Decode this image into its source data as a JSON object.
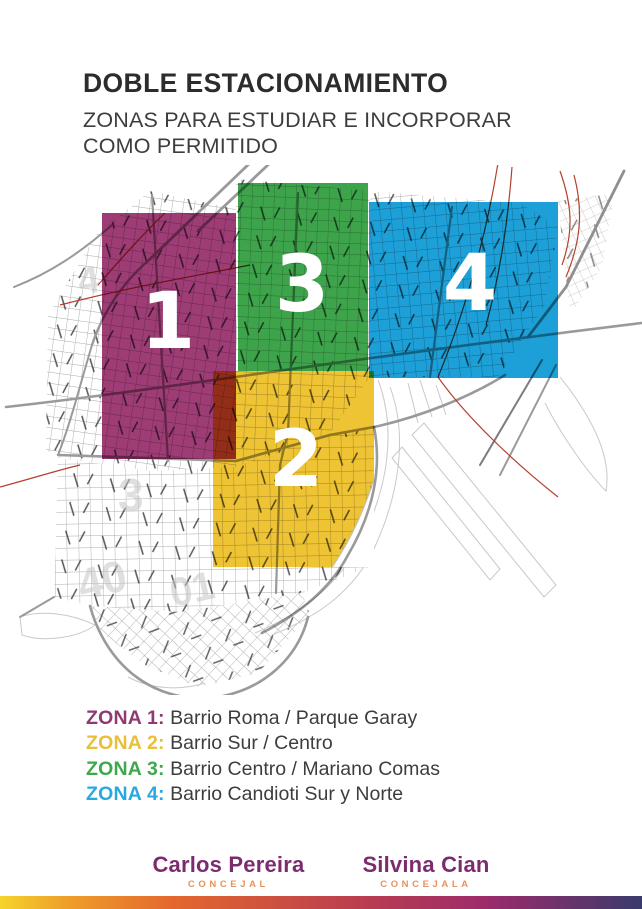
{
  "header": {
    "title": "DOBLE ESTACIONAMIENTO",
    "subtitle_line1": "ZONAS PARA ESTUDIAR E INCORPORAR",
    "subtitle_line2": "COMO PERMITIDO"
  },
  "map": {
    "zones": [
      {
        "number": "1",
        "color": "#9d3c75"
      },
      {
        "number": "2",
        "color": "#eec334"
      },
      {
        "number": "3",
        "color": "#3ea44b"
      },
      {
        "number": "4",
        "color": "#1d9fd8"
      }
    ],
    "watermarks": [
      "4",
      "3",
      "40",
      "01"
    ]
  },
  "legend": {
    "items": [
      {
        "label": "ZONA 1:",
        "value": "Barrio Roma / Parque Garay",
        "color": "#8e3a70"
      },
      {
        "label": "ZONA 2:",
        "value": "Barrio Sur / Centro",
        "color": "#e9bf3a"
      },
      {
        "label": "ZONA 3:",
        "value": "Barrio Centro / Mariano Comas",
        "color": "#3da84c"
      },
      {
        "label": "ZONA 4:",
        "value": "Barrio Candioti Sur y Norte",
        "color": "#29a9e1"
      }
    ]
  },
  "footer": {
    "officials": [
      {
        "name": "Carlos Pereira",
        "role": "CONCEJAL"
      },
      {
        "name": "Silvina Cian",
        "role": "CONCEJALA"
      }
    ],
    "name_color": "#7c2c6e",
    "role_color": "#e8925c",
    "bar_gradient": [
      "#f5d42c",
      "#efa02b",
      "#e4672e",
      "#bb3f4e",
      "#9c2b6b",
      "#3a3b6c"
    ]
  }
}
